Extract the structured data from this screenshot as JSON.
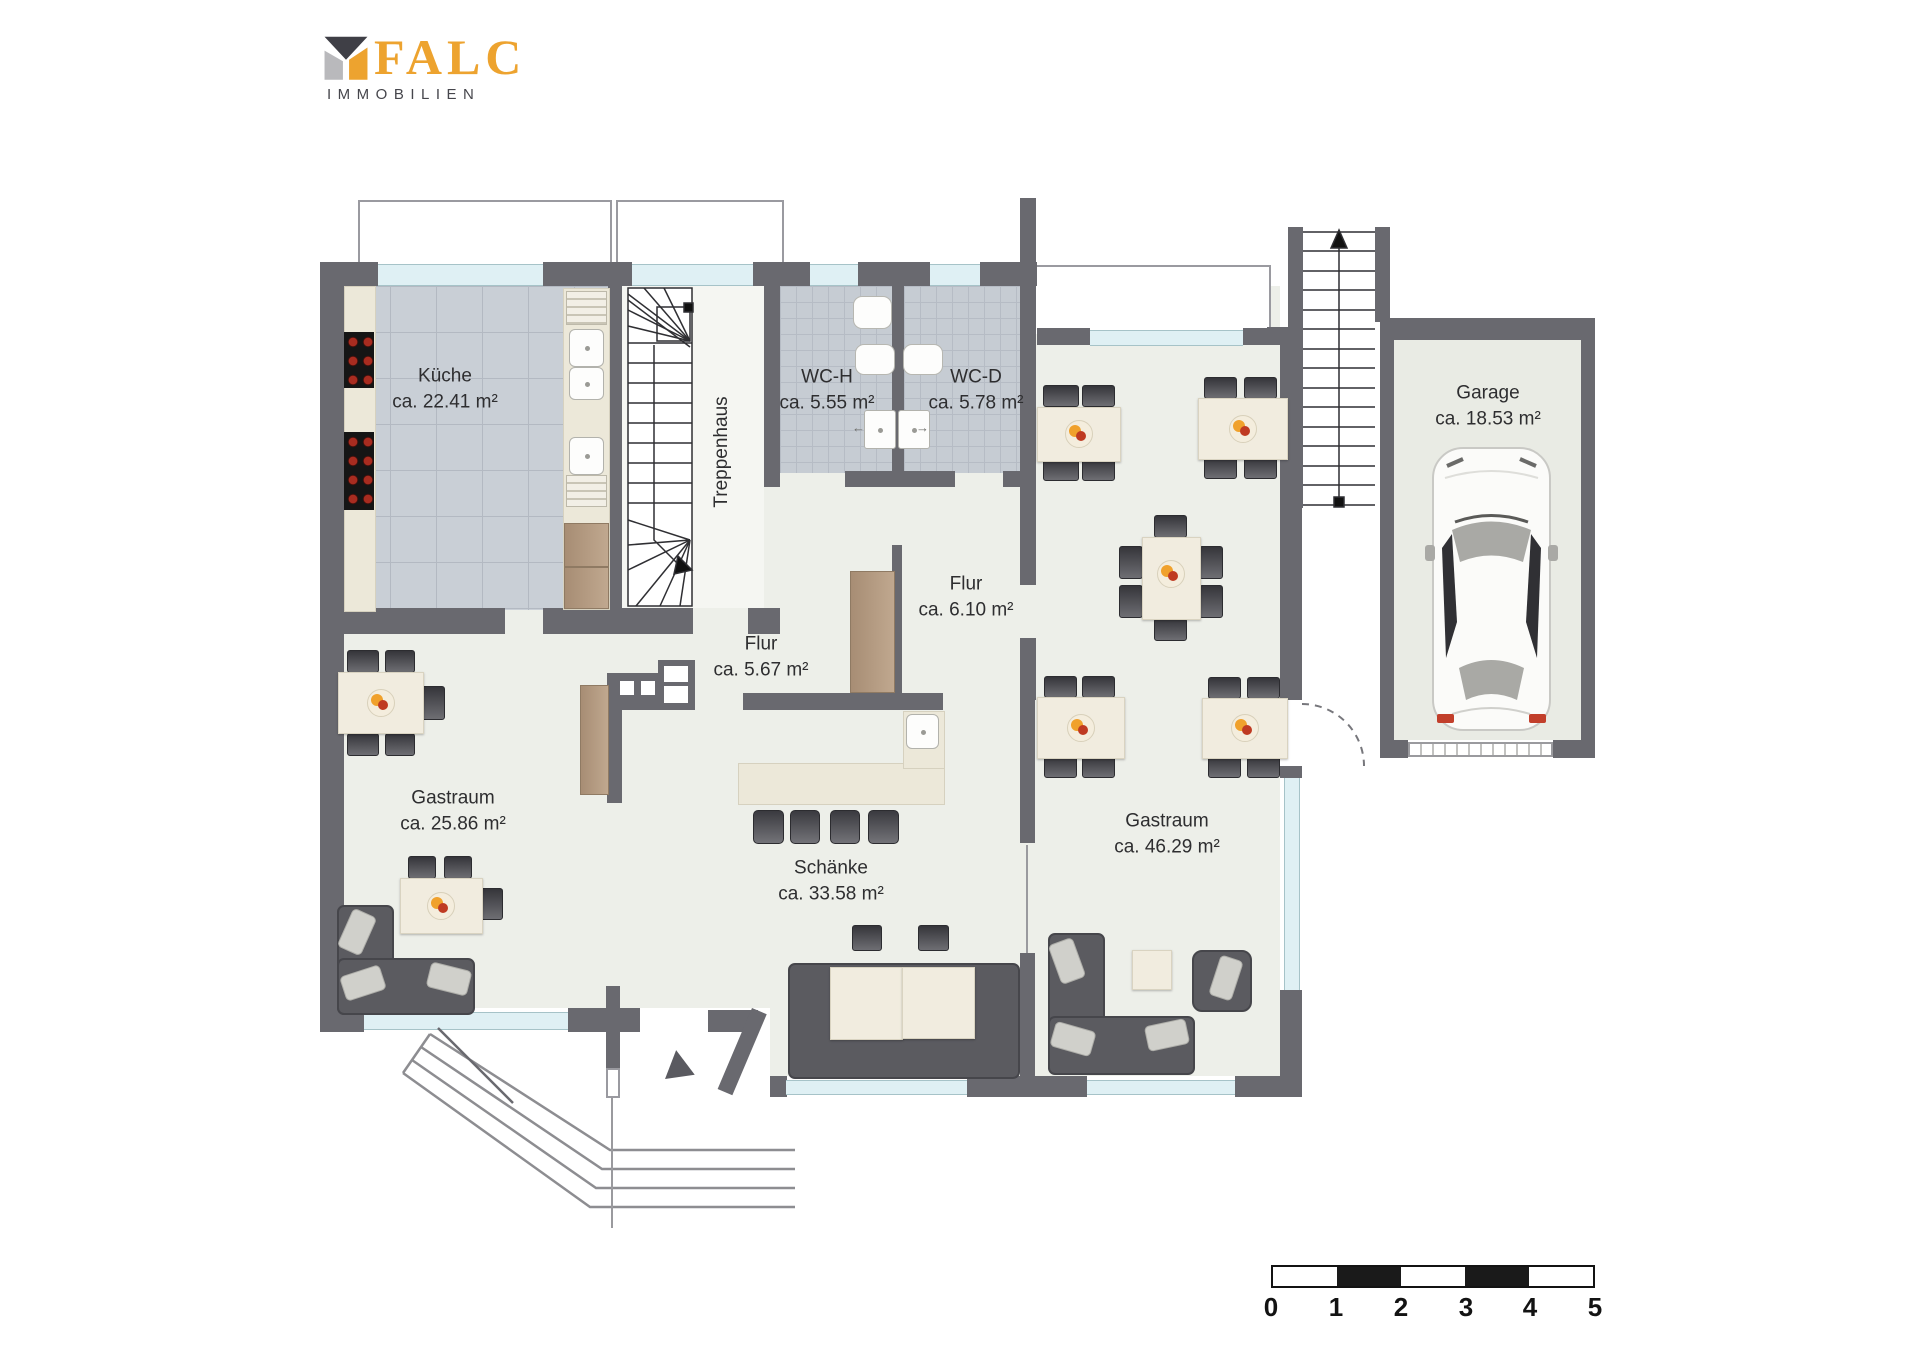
{
  "logo": {
    "brand": "FALC",
    "subtitle": "IMMOBILIEN"
  },
  "rooms": {
    "kueche": {
      "name": "Küche",
      "area": "ca. 22.41 m²"
    },
    "treppenhaus": {
      "name": "Treppenhaus",
      "area": ""
    },
    "wc_h": {
      "name": "WC-H",
      "area": "ca. 5.55 m²"
    },
    "wc_d": {
      "name": "WC-D",
      "area": "ca. 5.78 m²"
    },
    "garage": {
      "name": "Garage",
      "area": "ca. 18.53 m²"
    },
    "flur_gross": {
      "name": "Flur",
      "area": "ca. 6.10 m²"
    },
    "flur_klein": {
      "name": "Flur",
      "area": "ca. 5.67 m²"
    },
    "gastraum_links": {
      "name": "Gastraum",
      "area": "ca. 25.86 m²"
    },
    "schaenke": {
      "name": "Schänke",
      "area": "ca. 33.58 m²"
    },
    "gastraum_rechts": {
      "name": "Gastraum",
      "area": "ca. 46.29 m²"
    }
  },
  "scale": {
    "labels": [
      "0",
      "1",
      "2",
      "3",
      "4",
      "5"
    ]
  },
  "colors": {
    "wall": "#69696f",
    "floor": "#edefe9",
    "tile": "#c9cfd6",
    "window": "#dff0f4",
    "accent_orange": "#eda32f",
    "furniture_dark": "#4e4e54",
    "wood": "#b1977f"
  }
}
